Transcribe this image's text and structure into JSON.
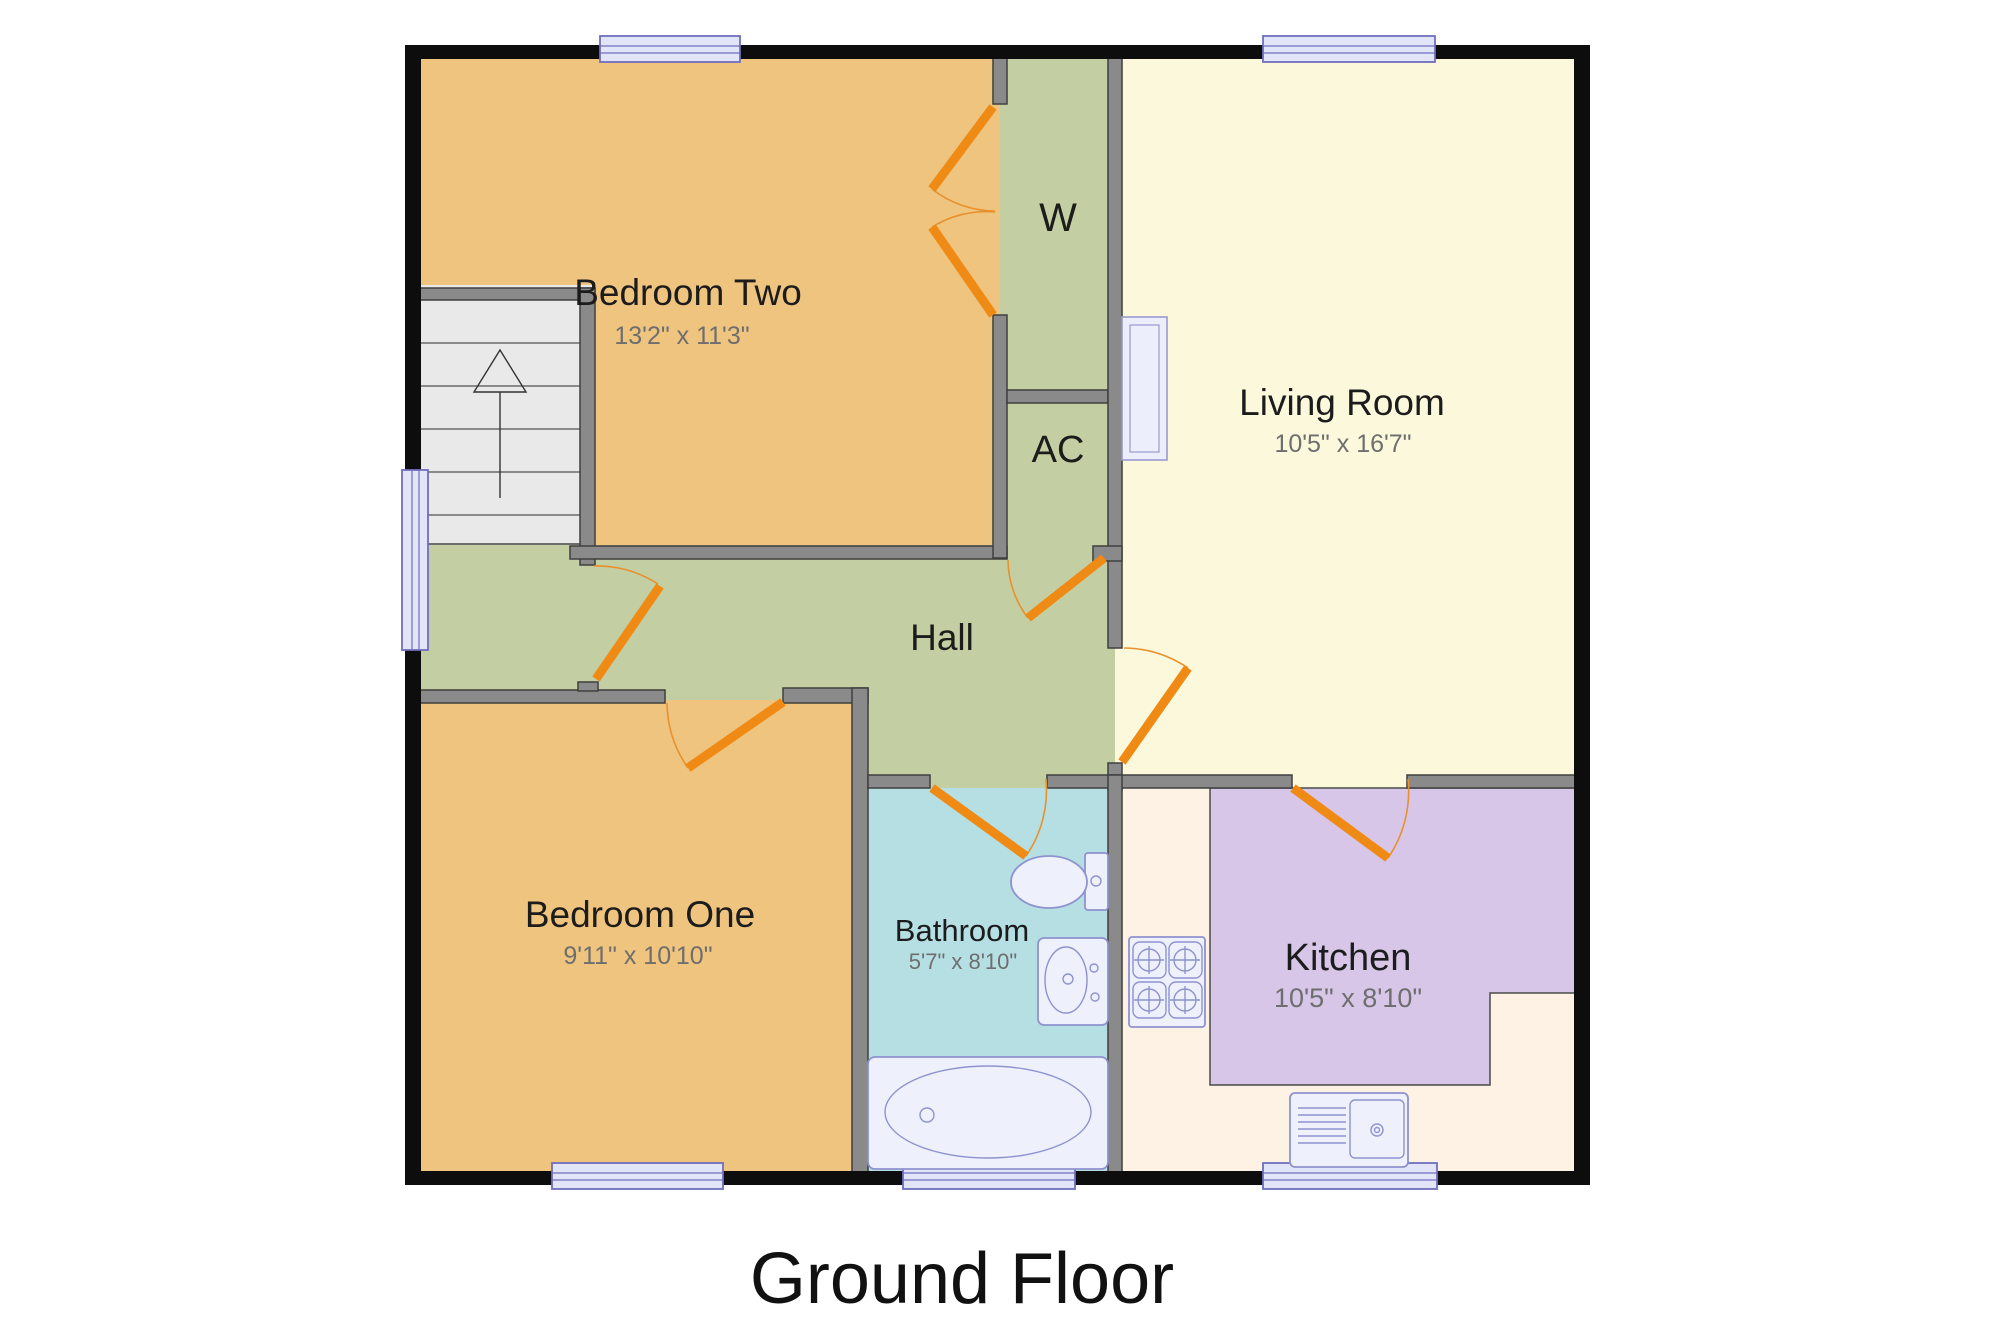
{
  "title": "Ground Floor",
  "rooms": {
    "bedroom_two": {
      "name": "Bedroom Two",
      "dims": "13'2\" x 11'3\""
    },
    "wardrobe": {
      "name": "W"
    },
    "ac": {
      "name": "AC"
    },
    "living_room": {
      "name": "Living Room",
      "dims": "10'5\" x 16'7\""
    },
    "hall": {
      "name": "Hall"
    },
    "bedroom_one": {
      "name": "Bedroom One",
      "dims": "9'11\" x 10'10\""
    },
    "bathroom": {
      "name": "Bathroom",
      "dims": "5'7\" x 8'10\""
    },
    "kitchen": {
      "name": "Kitchen",
      "dims": "10'5\" x 8'10\""
    }
  },
  "colors": {
    "bedroom_fill": "#eec47f",
    "hall_fill": "#c3cfa2",
    "living_room_fill": "#fcf8dc",
    "bathroom_fill": "#b5dfe3",
    "kitchen_fill": "#d7c6e7",
    "kitchen_floor_fill": "#fdf2e4",
    "stairs_fill": "#e9e9e9",
    "interior_wall": "#8a8a8a",
    "exterior_wall": "#0d0d0d",
    "window_fill": "#e2e5f8",
    "window_border": "#6f6fbe",
    "fixture_fill": "#eef0fc",
    "fixture_stroke": "#8e93cf",
    "door": "#ef8a15",
    "label_text": "#1c1c1c",
    "dims_text": "#6e6e6e"
  }
}
